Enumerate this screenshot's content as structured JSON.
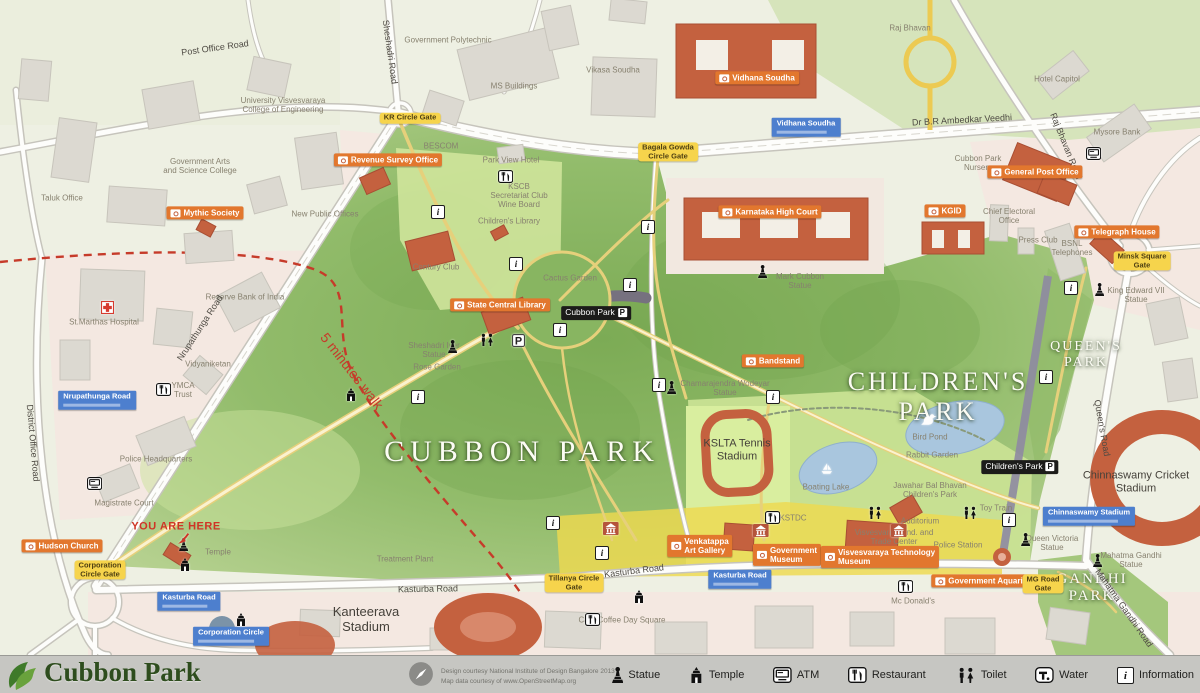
{
  "footer": {
    "title": "Cubbon Park",
    "credits_line1": "Design courtesy National Institute of Design Bangalore 2013",
    "credits_line2": "Map data courtesy of www.OpenStreetMap.org",
    "legend": [
      {
        "icon": "statue-icon",
        "label": "Statue"
      },
      {
        "icon": "temple-icon",
        "label": "Temple"
      },
      {
        "icon": "atm-icon",
        "label": "ATM"
      },
      {
        "icon": "restaurant-icon",
        "label": "Restaurant"
      },
      {
        "icon": "toilet-icon",
        "label": "Toilet"
      },
      {
        "icon": "water-icon",
        "label": "Water"
      },
      {
        "icon": "information-icon",
        "label": "Information"
      }
    ]
  },
  "colors": {
    "park_green": "#8fba68",
    "poi_orange": "#e2772e",
    "gate_yellow": "#f6d44c",
    "transit_blue": "#4d7fce",
    "landmark_red": "#c4613f",
    "walk_radius_red": "#c63b2a"
  },
  "map": {
    "park_titles": [
      {
        "t": "CUBBON PARK",
        "x": 522,
        "y": 452,
        "s": 30,
        "ls": 6
      },
      {
        "L": [
          "CHILDREN'S",
          "PARK"
        ],
        "x": 938,
        "y": 397,
        "s": 26,
        "ls": 3
      },
      {
        "L": [
          "QUEEN'S",
          "PARK"
        ],
        "x": 1086,
        "y": 355,
        "s": 14,
        "ls": 2
      },
      {
        "L": [
          "GANDHI",
          "PARK"
        ],
        "x": 1092,
        "y": 588,
        "s": 15,
        "ls": 2
      }
    ],
    "area_labels": [
      {
        "L": [
          "Kanteerava",
          "Stadium"
        ],
        "x": 366,
        "y": 620,
        "s": 13
      },
      {
        "L": [
          "Chinnaswamy Cricket",
          "Stadium"
        ],
        "x": 1136,
        "y": 482,
        "s": 11
      },
      {
        "L": [
          "KSLTA Tennis",
          "Stadium"
        ],
        "x": 737,
        "y": 450,
        "s": 11
      }
    ],
    "place_labels": [
      {
        "t": "Taluk Office",
        "x": 62,
        "y": 198
      },
      {
        "L": [
          "Government Arts",
          "and Science College"
        ],
        "x": 200,
        "y": 166
      },
      {
        "L": [
          "University Visvesvaraya",
          "College of Engineering"
        ],
        "x": 283,
        "y": 105
      },
      {
        "t": "Government Polytechnic",
        "x": 448,
        "y": 40
      },
      {
        "t": "MS Buildings",
        "x": 514,
        "y": 86
      },
      {
        "t": "Vikasa Soudha",
        "x": 613,
        "y": 70
      },
      {
        "t": "Raj Bhavan",
        "x": 910,
        "y": 28
      },
      {
        "t": "Hotel Capitol",
        "x": 1057,
        "y": 79
      },
      {
        "t": "Mysore Bank",
        "x": 1117,
        "y": 132
      },
      {
        "t": "New Public Offices",
        "x": 325,
        "y": 214
      },
      {
        "t": "BESCOM",
        "x": 441,
        "y": 146
      },
      {
        "t": "St.Marthas Hospital",
        "x": 104,
        "y": 322
      },
      {
        "t": "Reserve Bank of India",
        "x": 245,
        "y": 297
      },
      {
        "t": "Vidyaniketan",
        "x": 208,
        "y": 364
      },
      {
        "L": [
          "YMCA",
          "Trust"
        ],
        "x": 183,
        "y": 390
      },
      {
        "t": "Police Headquarters",
        "x": 156,
        "y": 459
      },
      {
        "t": "Magistrate Court",
        "x": 124,
        "y": 503
      },
      {
        "t": "Treatment Plant",
        "x": 405,
        "y": 559
      },
      {
        "L": [
          "Chief Electoral",
          "Office"
        ],
        "x": 1009,
        "y": 216
      },
      {
        "t": "Press Club",
        "x": 1038,
        "y": 240
      },
      {
        "L": [
          "BSNL",
          "Telephones"
        ],
        "x": 1072,
        "y": 248
      },
      {
        "t": "Mc Donald's",
        "x": 913,
        "y": 601
      },
      {
        "t": "Cafe Coffee Day Square",
        "x": 622,
        "y": 620
      },
      {
        "t": "Auditorium",
        "x": 920,
        "y": 521
      },
      {
        "L": [
          "Visvesvaraya Ind. and",
          "Trade Center"
        ],
        "x": 894,
        "y": 537
      },
      {
        "L": [
          "Jawahar Bal Bhavan",
          "Children's Park"
        ],
        "x": 930,
        "y": 490
      },
      {
        "t": "Rabbit Garden",
        "x": 932,
        "y": 455
      },
      {
        "t": "Bird Pond",
        "x": 930,
        "y": 437
      },
      {
        "t": "Boating Lake",
        "x": 826,
        "y": 487
      },
      {
        "t": "Toy Train",
        "x": 996,
        "y": 508
      },
      {
        "t": "Police Station",
        "x": 958,
        "y": 545
      },
      {
        "L": [
          "Queen Victoria",
          "Statue"
        ],
        "x": 1052,
        "y": 543
      },
      {
        "L": [
          "Mahatma Gandhi",
          "Statue"
        ],
        "x": 1131,
        "y": 560
      },
      {
        "L": [
          "King Edward VII",
          "Statue"
        ],
        "x": 1136,
        "y": 295
      },
      {
        "L": [
          "Sheshadri Iyer",
          "Statue"
        ],
        "x": 434,
        "y": 350
      },
      {
        "t": "Rose Garden",
        "x": 437,
        "y": 367
      },
      {
        "L": [
          "Chamarajendra Wodeyar",
          "Statue"
        ],
        "x": 725,
        "y": 388
      },
      {
        "L": [
          "Mark Cubbon",
          "Statue"
        ],
        "x": 800,
        "y": 281
      },
      {
        "t": "Temple",
        "x": 218,
        "y": 552
      },
      {
        "t": "KSTDC",
        "x": 793,
        "y": 518
      },
      {
        "L": [
          "Cubbon Park",
          "Nursery"
        ],
        "x": 978,
        "y": 163
      },
      {
        "t": "Park View Hotel",
        "x": 511,
        "y": 160
      },
      {
        "L": [
          "KSCB",
          "Secretariat Club",
          "Wine Board"
        ],
        "x": 519,
        "y": 196
      },
      {
        "t": "Children's Library",
        "x": 509,
        "y": 221
      },
      {
        "t": "Century Club",
        "x": 436,
        "y": 267
      },
      {
        "t": "Cactus Garden",
        "x": 570,
        "y": 278
      }
    ],
    "road_labels": [
      {
        "t": "Post Office Road",
        "x": 215,
        "y": 48,
        "r": -8
      },
      {
        "t": "Sheshadri Road",
        "x": 390,
        "y": 52,
        "r": 82
      },
      {
        "t": "Dr B.R Ambedkar Veedhi",
        "x": 962,
        "y": 120,
        "r": -3
      },
      {
        "t": "Raj Bhavan Road",
        "x": 1066,
        "y": 146,
        "r": 68
      },
      {
        "t": "Nrupathunga Road",
        "x": 200,
        "y": 328,
        "r": -57
      },
      {
        "t": "District Office Road",
        "x": 33,
        "y": 443,
        "r": 85
      },
      {
        "t": "Kasturba Road",
        "x": 428,
        "y": 589,
        "r": -1
      },
      {
        "t": "Kasturba Road",
        "x": 634,
        "y": 571,
        "r": -7
      },
      {
        "t": "Queen's Road",
        "x": 1102,
        "y": 428,
        "r": 80
      },
      {
        "t": "Mahatma Gandhi Road",
        "x": 1124,
        "y": 608,
        "r": 55
      }
    ],
    "poi_labels": [
      {
        "t": "Mythic Society",
        "x": 205,
        "y": 213
      },
      {
        "t": "Revenue Survey Office",
        "x": 388,
        "y": 160
      },
      {
        "t": "Vidhana Soudha",
        "x": 757,
        "y": 78
      },
      {
        "t": "Karnataka High Court",
        "x": 770,
        "y": 212
      },
      {
        "t": "KGID",
        "x": 945,
        "y": 211
      },
      {
        "t": "General Post Office",
        "x": 1035,
        "y": 172
      },
      {
        "t": "Telegraph House",
        "x": 1117,
        "y": 232
      },
      {
        "t": "State Central Library",
        "x": 500,
        "y": 305
      },
      {
        "t": "Bandstand",
        "x": 773,
        "y": 361
      },
      {
        "t": "Hudson Church",
        "x": 62,
        "y": 546
      },
      {
        "L": [
          "Venkatappa",
          "Art Gallery"
        ],
        "x": 700,
        "y": 546
      },
      {
        "L": [
          "Government",
          "Museum"
        ],
        "x": 787,
        "y": 555
      },
      {
        "L": [
          "Visvesvaraya Technology",
          "Museum"
        ],
        "x": 880,
        "y": 557
      },
      {
        "t": "Government Aquarium",
        "x": 985,
        "y": 581
      }
    ],
    "gate_labels": [
      {
        "t": "KR Circle Gate",
        "x": 410,
        "y": 118
      },
      {
        "L": [
          "Bagala Gowda",
          "Circle Gate"
        ],
        "x": 668,
        "y": 152
      },
      {
        "L": [
          "Minsk Square",
          "Gate"
        ],
        "x": 1142,
        "y": 261
      },
      {
        "L": [
          "Corporation",
          "Circle Gate"
        ],
        "x": 100,
        "y": 570
      },
      {
        "L": [
          "Tillanya Circle",
          "Gate"
        ],
        "x": 574,
        "y": 583
      },
      {
        "L": [
          "MG Road",
          "Gate"
        ],
        "x": 1043,
        "y": 584
      }
    ],
    "transit_labels": [
      {
        "t": "Nrupathunga Road",
        "x": 97,
        "y": 400
      },
      {
        "t": "Kasturba Road",
        "x": 189,
        "y": 601
      },
      {
        "t": "Corporation Circle",
        "x": 231,
        "y": 636
      },
      {
        "t": "Kasturba Road",
        "x": 740,
        "y": 579
      },
      {
        "t": "Vidhana Soudha",
        "x": 806,
        "y": 127
      },
      {
        "t": "Chinnaswamy Stadium",
        "x": 1089,
        "y": 516
      }
    ],
    "parking_labels": [
      {
        "t": "Cubbon Park",
        "x": 596,
        "y": 313
      },
      {
        "t": "Children's Park",
        "x": 1020,
        "y": 467
      }
    ],
    "annotations": [
      {
        "t": "YOU ARE HERE",
        "x": 176,
        "y": 527,
        "k": "here"
      },
      {
        "t": "5 minutes walk",
        "x": 352,
        "y": 371,
        "r": 52,
        "k": "walk"
      }
    ],
    "icons": [
      {
        "icon": "information-icon",
        "x": 438,
        "y": 212
      },
      {
        "icon": "information-icon",
        "x": 516,
        "y": 264
      },
      {
        "icon": "information-icon",
        "x": 560,
        "y": 330
      },
      {
        "icon": "information-icon",
        "x": 630,
        "y": 285
      },
      {
        "icon": "information-icon",
        "x": 648,
        "y": 227
      },
      {
        "icon": "information-icon",
        "x": 418,
        "y": 397
      },
      {
        "icon": "information-icon",
        "x": 659,
        "y": 385
      },
      {
        "icon": "information-icon",
        "x": 773,
        "y": 397
      },
      {
        "icon": "information-icon",
        "x": 1071,
        "y": 288
      },
      {
        "icon": "information-icon",
        "x": 1046,
        "y": 377
      },
      {
        "icon": "information-icon",
        "x": 553,
        "y": 523
      },
      {
        "icon": "information-icon",
        "x": 602,
        "y": 553
      },
      {
        "icon": "information-icon",
        "x": 1009,
        "y": 520
      },
      {
        "icon": "statue-icon",
        "x": 455,
        "y": 347
      },
      {
        "icon": "statue-icon",
        "x": 674,
        "y": 388
      },
      {
        "icon": "statue-icon",
        "x": 765,
        "y": 272
      },
      {
        "icon": "statue-icon",
        "x": 1102,
        "y": 290
      },
      {
        "icon": "statue-icon",
        "x": 1028,
        "y": 540
      },
      {
        "icon": "statue-icon",
        "x": 1100,
        "y": 561
      },
      {
        "icon": "statue-icon",
        "x": 186,
        "y": 545
      },
      {
        "icon": "temple-icon",
        "x": 352,
        "y": 395
      },
      {
        "icon": "temple-icon",
        "x": 186,
        "y": 565
      },
      {
        "icon": "temple-icon",
        "x": 242,
        "y": 620
      },
      {
        "icon": "temple-icon",
        "x": 640,
        "y": 597
      },
      {
        "icon": "restaurant-icon",
        "x": 163,
        "y": 390
      },
      {
        "icon": "restaurant-icon",
        "x": 505,
        "y": 177
      },
      {
        "icon": "restaurant-icon",
        "x": 772,
        "y": 518
      },
      {
        "icon": "restaurant-icon",
        "x": 592,
        "y": 620
      },
      {
        "icon": "restaurant-icon",
        "x": 905,
        "y": 587
      },
      {
        "icon": "toilet-icon",
        "x": 485,
        "y": 340
      },
      {
        "icon": "toilet-icon",
        "x": 873,
        "y": 513
      },
      {
        "icon": "toilet-icon",
        "x": 968,
        "y": 513
      },
      {
        "icon": "atm-icon",
        "x": 1093,
        "y": 154
      },
      {
        "icon": "atm-icon",
        "x": 94,
        "y": 484
      },
      {
        "icon": "cross-icon",
        "x": 108,
        "y": 308
      },
      {
        "icon": "parking-icon",
        "x": 519,
        "y": 341
      },
      {
        "icon": "duck-icon",
        "x": 927,
        "y": 420
      },
      {
        "icon": "boat-icon",
        "x": 826,
        "y": 469
      },
      {
        "icon": "museum-icon",
        "x": 610,
        "y": 529
      },
      {
        "icon": "museum-icon",
        "x": 760,
        "y": 531
      },
      {
        "icon": "museum-icon",
        "x": 898,
        "y": 531
      },
      {
        "icon": "arrow-icon",
        "x": 184,
        "y": 539
      }
    ]
  }
}
